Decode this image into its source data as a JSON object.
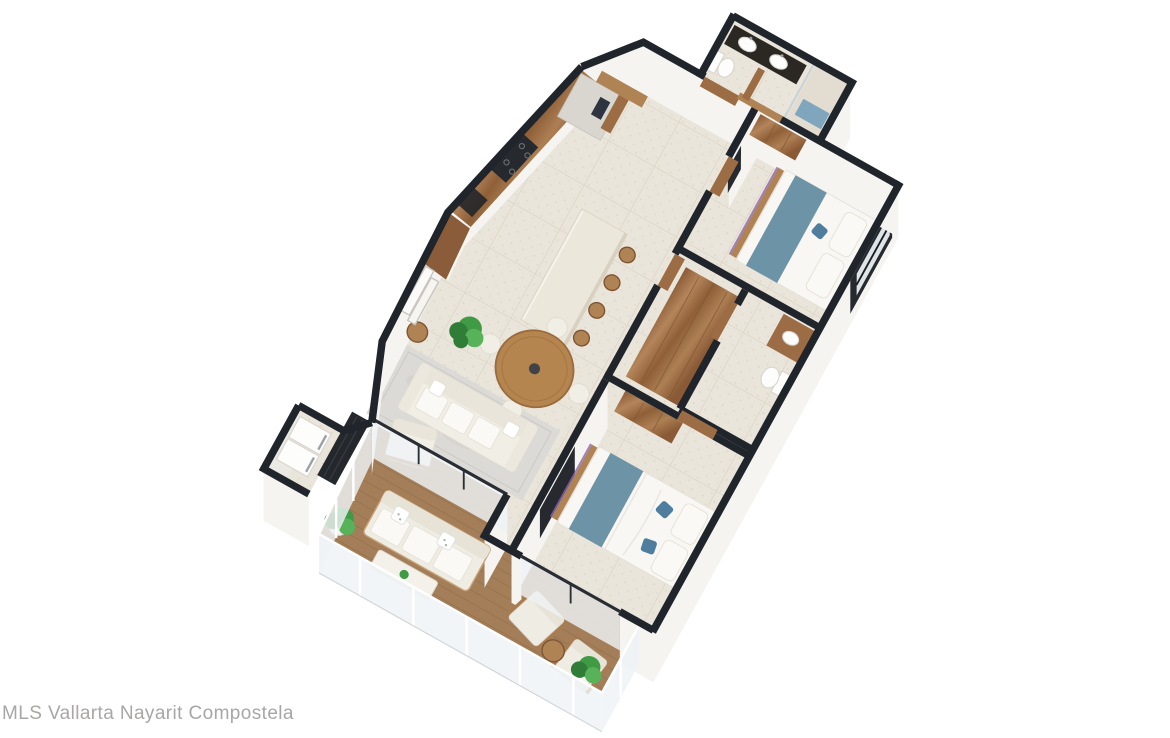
{
  "watermark": {
    "text": "MLS Vallarta Nayarit Compostela"
  },
  "scene": {
    "type": "3d-floor-plan-render",
    "view": "isometric-aerial",
    "property": "two-bedroom apartment with large terrace",
    "rooms": [
      {
        "name": "entry-hall",
        "furniture": [
          "wood entry door",
          "wood door frames"
        ]
      },
      {
        "name": "bathroom-1",
        "furniture": [
          "dark double-sink vanity",
          "walk-in shower with glass",
          "blue shower mat",
          "toilet"
        ]
      },
      {
        "name": "bedroom-2",
        "furniture": [
          "double bed with blue runner",
          "wood bench",
          "wood wardrobe",
          "wall tv",
          "window"
        ]
      },
      {
        "name": "kitchen",
        "furniture": [
          "walnut upper cabinets",
          "black cooktop with oven",
          "counter sink",
          "tall fridge unit",
          "stone island",
          "4 wood bar stools"
        ]
      },
      {
        "name": "dining-area",
        "furniture": [
          "round wood table",
          "4 white shell chairs",
          "potted plant",
          "round side table"
        ]
      },
      {
        "name": "living-room",
        "furniture": [
          "white 3-seat sofa",
          "white armchair",
          "gray marble rug",
          "leaning art frames",
          "wall tv"
        ]
      },
      {
        "name": "walk-in-closet",
        "furniture": [
          "wood wardrobe unit"
        ]
      },
      {
        "name": "bathroom-2",
        "furniture": [
          "wood vanity with vessel sink",
          "toilet"
        ]
      },
      {
        "name": "master-bedroom",
        "furniture": [
          "double bed with blue runner",
          "blue throw pillows",
          "wood bench",
          "wood wardrobe",
          "sliding door to terrace"
        ]
      },
      {
        "name": "laundry-closet",
        "furniture": [
          "stacked washer and dryer",
          "dark sliding panels"
        ]
      },
      {
        "name": "terrace",
        "furniture": [
          "wood plank deck",
          "glass railing",
          "outdoor sofa",
          "white coffee table",
          "2 lounge chairs",
          "round wood side table",
          "2 potted plants"
        ]
      }
    ],
    "palette": {
      "background": "#ffffff",
      "wall_cap": "#20242b",
      "wall_face": "#f5f4f1",
      "wall_face_shaded": "#ebe9e4",
      "tile_floor": "#eae5da",
      "tile_line": "#ddd6c8",
      "terrace_wood": "#a37e59",
      "plank_line": "#8d6a47",
      "wood": "#9c6c44",
      "wood_light": "#b08355",
      "wood_dark": "#7d5533",
      "furniture_white": "#f1eee6",
      "bed_runner_blue": "#6d93a6",
      "accent_blue": "#4f7d9e",
      "appliance_dark": "#26292e",
      "glass": "#eff3f5",
      "plant_green": "#3f9b44",
      "plant_green_dark": "#2f7d36",
      "rug_gray": "#dcdad6",
      "watermark_gray": "#a9a7a5"
    }
  }
}
